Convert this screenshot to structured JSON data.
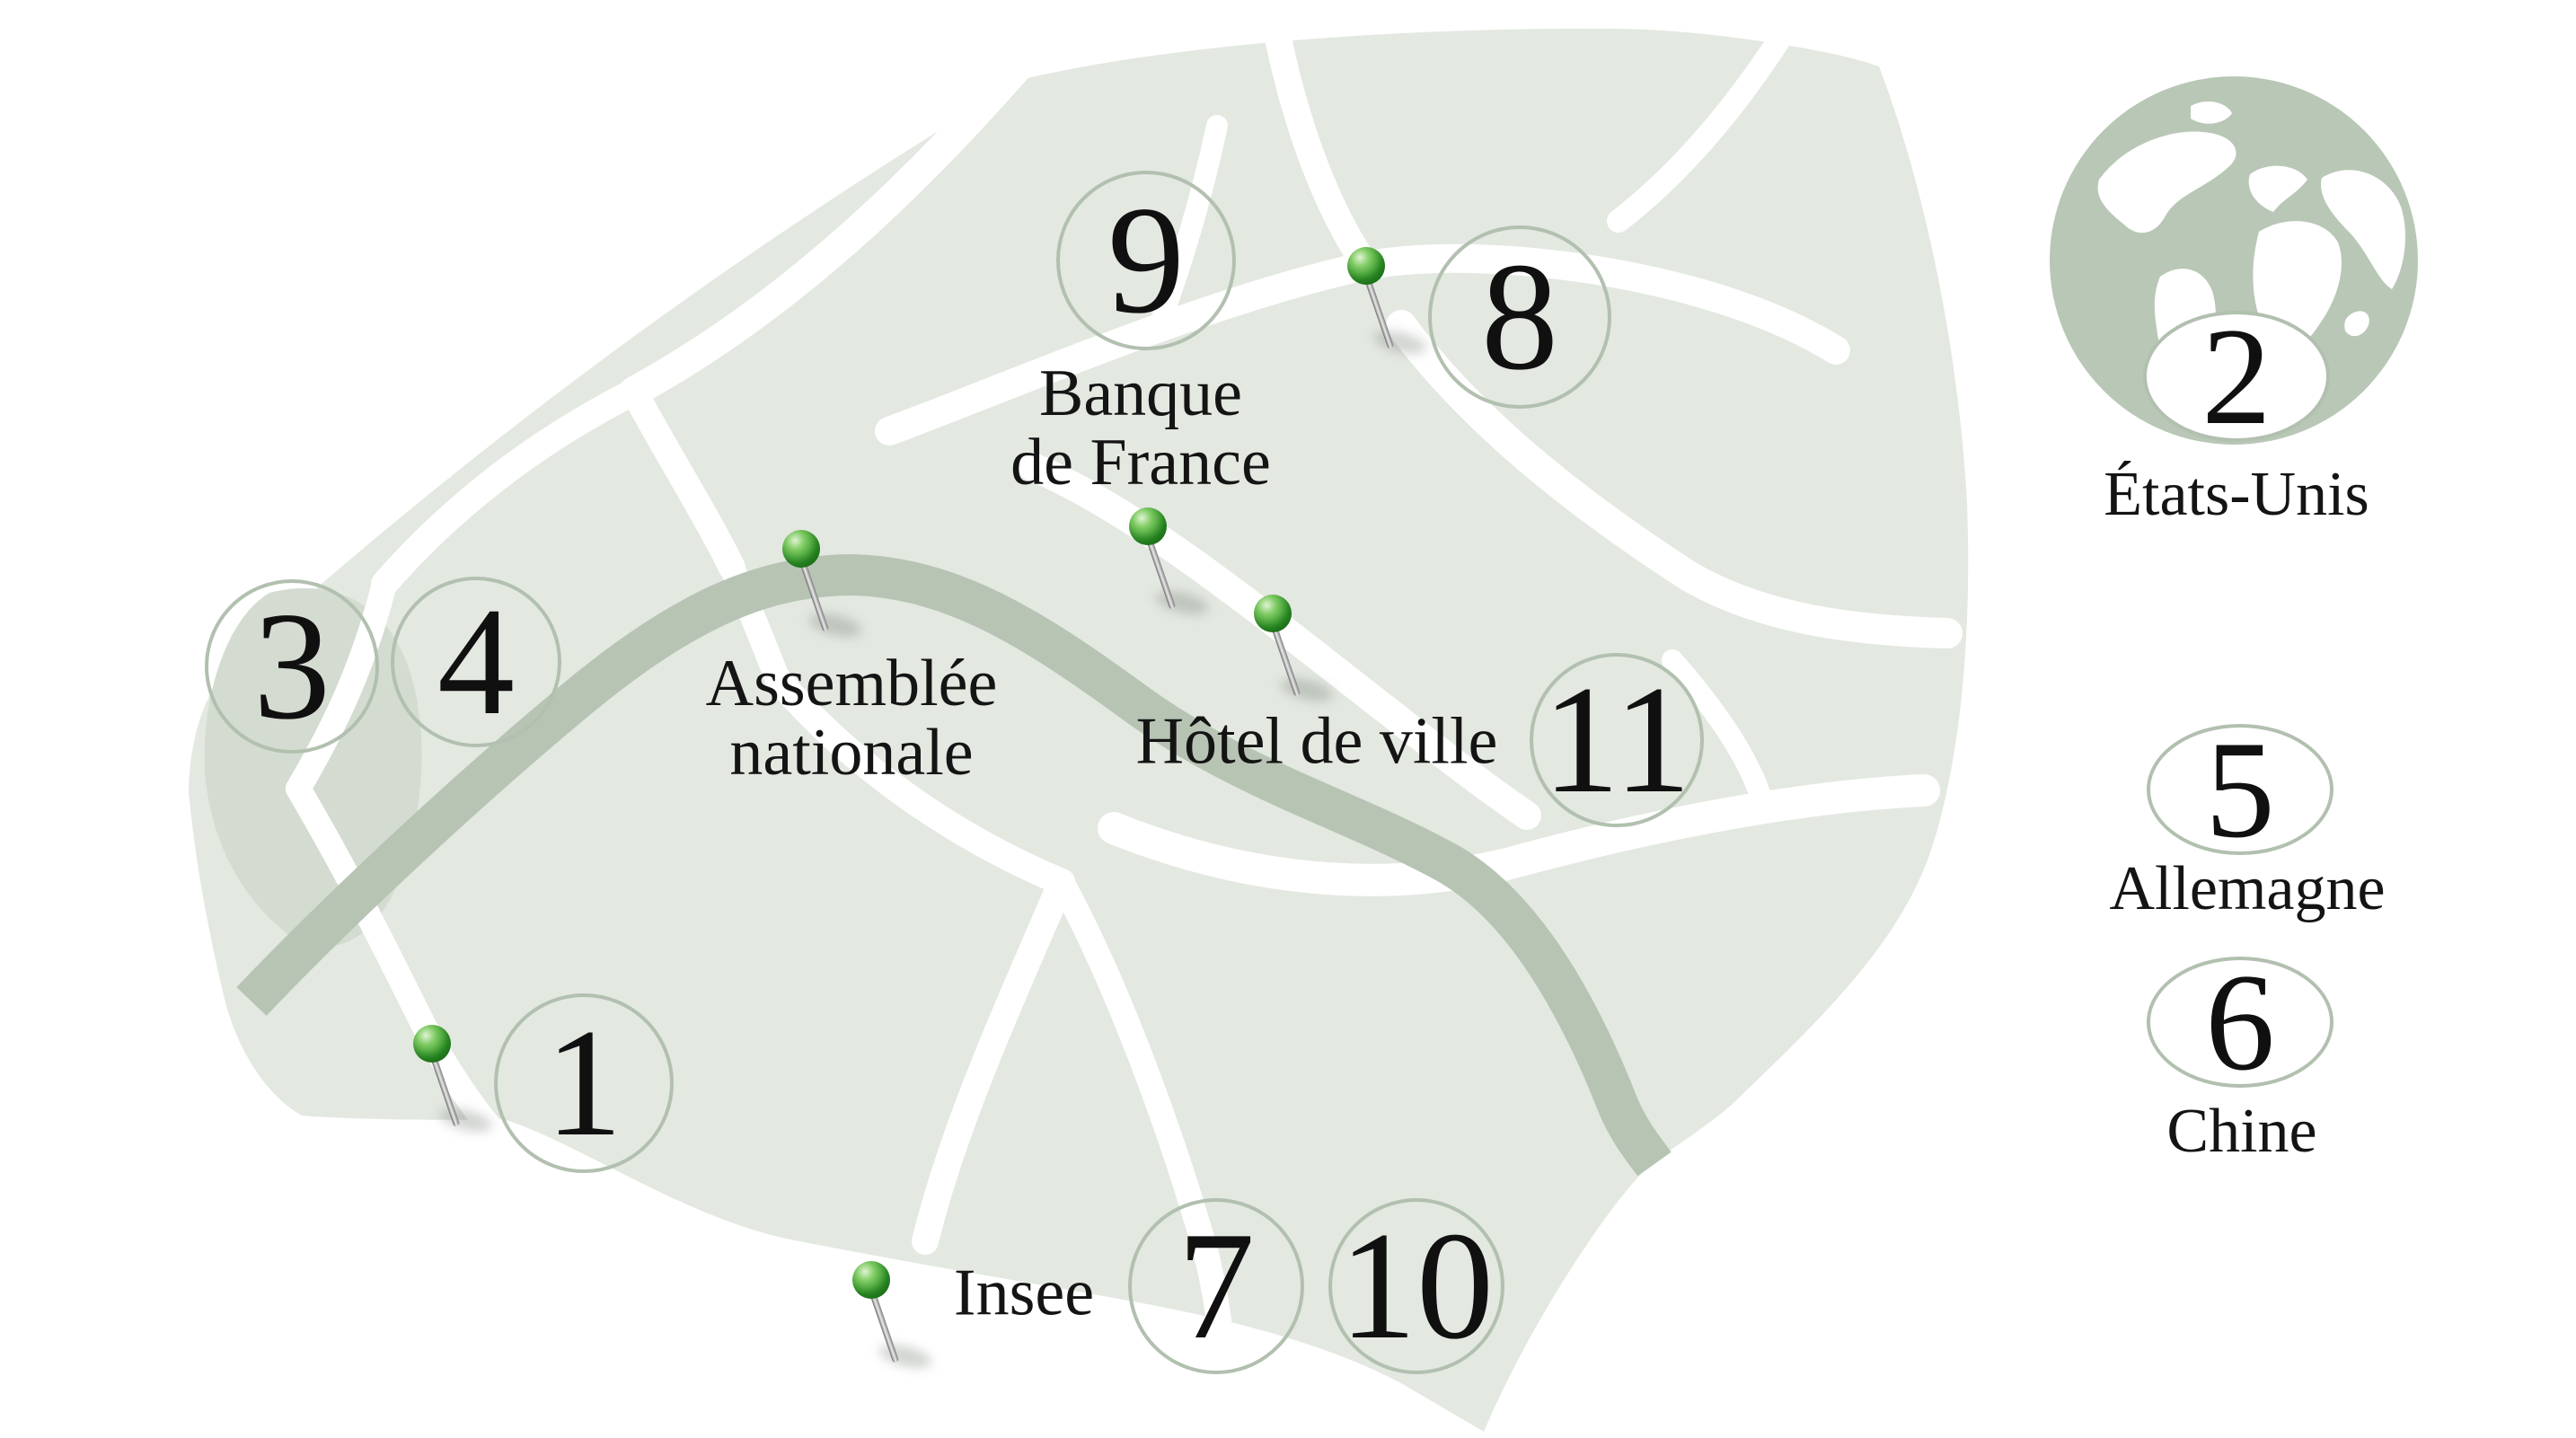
{
  "map": {
    "place_labels": {
      "banque_line1": "Banque",
      "banque_line2": "de France",
      "assemblee_line1": "Assemblée",
      "assemblee_line2": "nationale",
      "hotel": "Hôtel de ville",
      "insee": "Insee"
    },
    "markers": [
      {
        "number": "1"
      },
      {
        "number": "3"
      },
      {
        "number": "4"
      },
      {
        "number": "7"
      },
      {
        "number": "8"
      },
      {
        "number": "9"
      },
      {
        "number": "10"
      },
      {
        "number": "11"
      }
    ],
    "icons": {
      "pin": "map-pin-icon",
      "globe": "globe-icon"
    }
  },
  "legend": {
    "items": [
      {
        "number": "2",
        "label": "États-Unis"
      },
      {
        "number": "5",
        "label": "Allemagne"
      },
      {
        "number": "6",
        "label": "Chine"
      }
    ]
  },
  "colors": {
    "map_fill": "#e3e8e1",
    "map_patch": "#d4dcd1",
    "river": "#b7c4b4",
    "road": "#ffffff",
    "circle_stroke": "#b2c0af",
    "pin_green": "#2f9427",
    "globe": "#b9c7b6",
    "text": "#141414"
  }
}
